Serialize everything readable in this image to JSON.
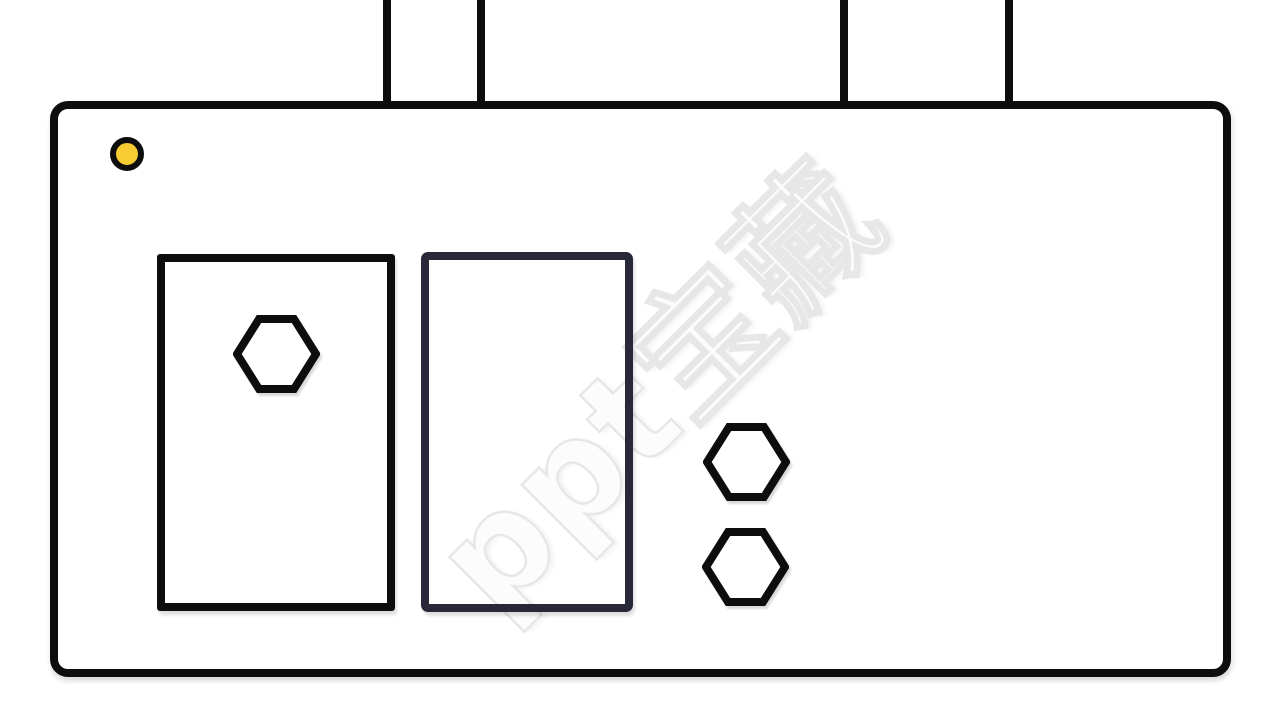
{
  "illustration": {
    "name": "machine-outline-clipart",
    "watermark": {
      "text": "ppt宝藏"
    }
  },
  "colors": {
    "background": "#ffffff",
    "outline": "#0d0d0d",
    "panel_dark": "#282839",
    "indicator_fill": "#f6cc32",
    "indicator_ring": "#0d0d0d",
    "watermark_fill": "#fcfcfc",
    "watermark_stroke": "#e7e7e7"
  }
}
